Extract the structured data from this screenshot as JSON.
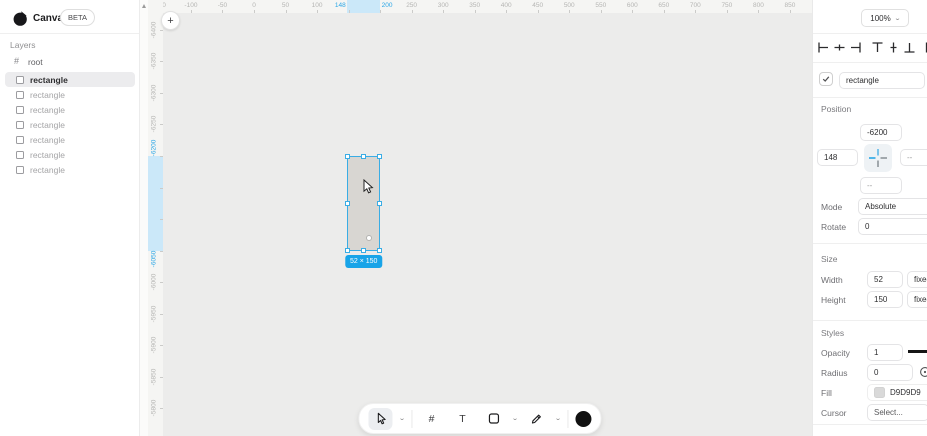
{
  "app": {
    "name": "Canvas",
    "beta_badge": "BETA",
    "zoom_level": "100%"
  },
  "sidebar": {
    "layers_label": "Layers",
    "root_label": "root",
    "items": [
      {
        "label": "rectangle",
        "selected": true
      },
      {
        "label": "rectangle",
        "selected": false
      },
      {
        "label": "rectangle",
        "selected": false
      },
      {
        "label": "rectangle",
        "selected": false
      },
      {
        "label": "rectangle",
        "selected": false
      },
      {
        "label": "rectangle",
        "selected": false
      },
      {
        "label": "rectangle",
        "selected": false
      }
    ]
  },
  "rulers": {
    "horizontal": {
      "labels": [
        -150,
        -100,
        -50,
        0,
        50,
        100,
        250,
        300,
        350,
        400,
        450,
        500,
        550,
        600,
        650,
        700,
        750,
        800,
        850
      ],
      "tick_start": -150,
      "tick_end": 850,
      "tick_step": 50,
      "selection": {
        "from": 148,
        "to": 200,
        "from_label": "148",
        "to_label": "200"
      }
    },
    "vertical": {
      "labels": [
        -6400,
        -6350,
        -6300,
        -6250,
        -6000,
        -5950,
        -5900,
        -5850,
        -5800
      ],
      "tick_start": -6400,
      "tick_end": -5750,
      "tick_step": 50,
      "selection": {
        "from": -6200,
        "to": -6050,
        "from_label": "-6200",
        "to_label": "-6050"
      }
    }
  },
  "canvas": {
    "selection": {
      "x": 148,
      "y": -6200,
      "width": 52,
      "height": 150
    },
    "dimension_badge": "52 × 150",
    "plus_button": "+"
  },
  "toolbar": {
    "tools": [
      "select-tool",
      "frame-tool",
      "text-tool",
      "shape-tool",
      "pen-tool",
      "color-swatch"
    ],
    "frame_glyph": "#",
    "text_glyph": "T"
  },
  "inspector": {
    "align_tools": [
      "align-left",
      "align-center-horizontal",
      "align-right",
      "align-top",
      "align-middle-vertical",
      "align-bottom",
      "distribute-horizontal"
    ],
    "name_field": {
      "value": "rectangle",
      "checked": true
    },
    "position": {
      "label": "Position",
      "x": "148",
      "y": "-6200",
      "right": "--",
      "bottom": "--"
    },
    "mode": {
      "label": "Mode",
      "value": "Absolute"
    },
    "rotate": {
      "label": "Rotate",
      "value": "0"
    },
    "size": {
      "label": "Size",
      "width_label": "Width",
      "width": "52",
      "width_mode": "fixed",
      "height_label": "Height",
      "height": "150",
      "height_mode": "fixed"
    },
    "styles": {
      "label": "Styles",
      "opacity_label": "Opacity",
      "opacity": "1",
      "radius_label": "Radius",
      "radius": "0",
      "fill_label": "Fill",
      "fill_hex": "D9D9D9",
      "fill_color": "#D9D9D9",
      "cursor_label": "Cursor",
      "cursor_value": "Select..."
    }
  },
  "colors": {
    "accent_blue": "#2aa6e6",
    "selection_blue": "#3aade5",
    "ruler_highlight": "#cbe8f9",
    "badge_blue": "#18a4e8",
    "canvas_bg": "#ececeb",
    "shape_fill": "#D9D9D9"
  }
}
